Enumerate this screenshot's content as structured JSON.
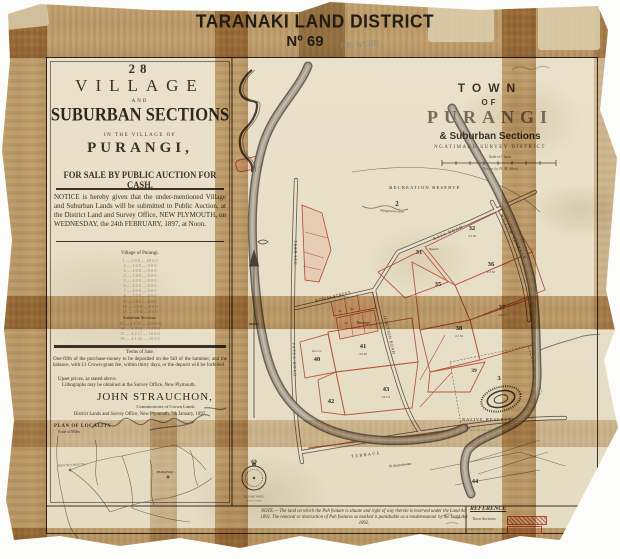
{
  "header": {
    "district": "TARANAKI LAND DISTRICT",
    "number": "Nº 69",
    "pencil_note": "F.R. WEBB"
  },
  "notice": {
    "count": "28",
    "village": "VILLAGE",
    "and": "AND",
    "suburban": "SUBURBAN SECTIONS",
    "in_village_of": "IN THE VILLAGE OF",
    "name": "PURANGI,",
    "sale_line": "FOR SALE BY PUBLIC AUCTION FOR CASH.",
    "body": "NOTICE is hereby given that the under-mentioned Village and Suburban Lands will be submitted to Public Auction, at the District Land and Survey Office, NEW PLYMOUTH, on WEDNESDAY, the 24th FEBRUARY, 1897, at Noon.",
    "village_of_heading": "Village of Purangi.",
    "village_table": "1 — 1 0 0 — £8 0 0\n2 — 1 0 0 — 8 0 0\n3 — 1 0 0 — 8 0 0\n4 — 1 0 0 — 8 0 0\n5 — 1 0 0 — 8 0 0\n6 — 1 0 0 — 8 0 0\n7 — 1 0 0 — 8 0 0\n8 — 1 0 0 — 8 0 0\n9 — 1 0 0 — 8 0 0\n10 — 1 0 0 — 8 0 0\n11 — 1 0 0 — 8 0 0",
    "suburban_heading": "Suburban Sections.",
    "suburban_table": "35 — 4 1 32 — £10 0 0\n36 — 0 3 32 — 12 0 0\n37 — 4 2 17 — 10 0 0\n38 — 4 1 32 — 10 0 0",
    "terms_heading": "Terms of Sale.",
    "terms_body": "One-fifth of the purchase-money to be deposited on the fall of the hammer, and the balance, with £1 Crown-grant fee, within thirty days, or the deposit will be forfeited.",
    "upset": "Upset prices, as stated above.",
    "lithographs": "Lithographs may be obtained at the Survey Office, New Plymouth.",
    "signature": "JOHN STRAUCHON,",
    "signature_title": "Commissioner of Crown Lands.",
    "office_line": "District Lands and Survey Office, New Plymouth, 7th January, 1897.",
    "plan_heading": "PLAN OF LOCALITY",
    "plan_scale": "Scale of Miles"
  },
  "locality": {
    "new_plymouth": "NEW PLYMOUTH",
    "purangi": "PURANGI"
  },
  "map": {
    "title1": "TOWN",
    "title2": "OF",
    "title3": "PURANGI",
    "title4": "& Suburban Sections",
    "district_line": "NGATIMARU SURVEY DISTRICT",
    "scale_label": "Scale of Chains",
    "drawn_by": "Drawn by H. M. Skeet",
    "labels": {
      "recreation": "RECREATION RESERVE",
      "stream": "Mangatotara Strm",
      "ngaere": "Ngaere",
      "purangi_blk": "Purangi",
      "reserve40": "Reserve",
      "komai": "KOMAI STREET",
      "junction": "JUNCTION ROAD",
      "willow": "WILLOW TERRACE",
      "terrace_w": "TERRACE",
      "patea": "PATEA ROAD",
      "rata": "RATA ROAD",
      "native": "NATIVE RESERVE",
      "terrace_s": "TERRACE",
      "te_aro": "Te Aroputewata",
      "seal_line1": "S COOKE WHITE",
      "seal_line2": "PHOTO LITHO"
    },
    "sections": {
      "s2": "2",
      "s3": "3",
      "s31": "31",
      "s32": "32",
      "s35": "35",
      "s36": "36",
      "s37": "37",
      "s38": "38",
      "s39": "39",
      "s40": "40",
      "s41": "41",
      "s42": "42",
      "s43": "43",
      "s44": "44",
      "t21": "21",
      "t22": "22",
      "t23": "23"
    },
    "areas": {
      "a32": "4 3 20",
      "a36": "0 3 32",
      "a37": "4 2 17",
      "a38": "4 1 32",
      "a41": "3 0 20",
      "a43": "10 1 0"
    }
  },
  "footer": {
    "note": "NOTE.— The land on which the Pah feature is situate and right of way thereto is reserved under the Land Act 1892. The removal or destruction of Pah features so marked is punishable as a misdemeanour by the Land Act 1892.",
    "reference_heading": "REFERENCE",
    "ref_item1": "Town Sections",
    "ref_item2": "Suburban Sections"
  },
  "colors": {
    "tape": "#b98c4e",
    "red": "#b04a32",
    "pink": "#e8bda6",
    "river": "#a8a193",
    "ink": "#332c22"
  }
}
